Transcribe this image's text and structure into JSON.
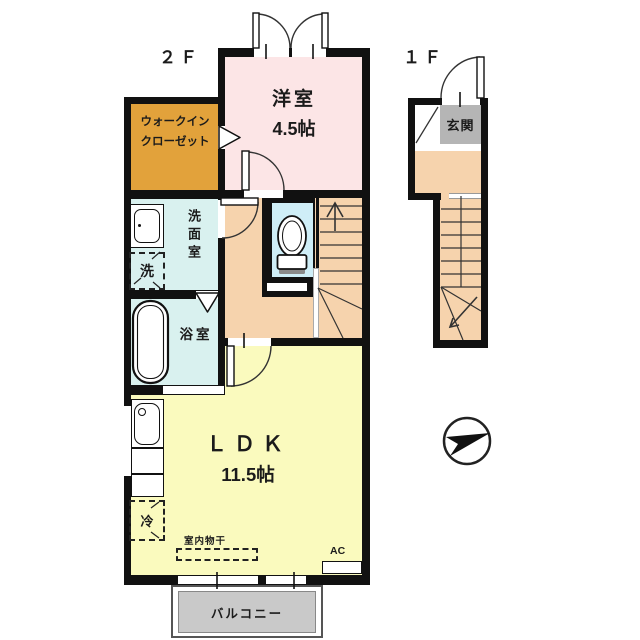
{
  "floor_labels": {
    "second_floor": "２Ｆ",
    "first_floor": "１Ｆ"
  },
  "rooms": {
    "western_room": {
      "name": "洋室",
      "area": "4.5帖"
    },
    "walk_in_closet": {
      "line1": "ウォークイン",
      "line2": "クローゼット"
    },
    "washroom": {
      "name": "洗面室"
    },
    "bathroom": {
      "name": "浴室"
    },
    "ldk": {
      "name": "ＬＤＫ",
      "area": "11.5帖"
    },
    "entrance": {
      "name": "玄関"
    },
    "balcony": {
      "name": "バルコニー"
    }
  },
  "fixtures": {
    "washing_machine": "洗",
    "refrigerator": "冷",
    "indoor_laundry": "室内物干",
    "air_conditioner": "AC"
  },
  "icons": {
    "compass": "north-direction-arrow",
    "stairs_up_arrow": "stair-direction-arrow",
    "toilet": "toilet-bowl",
    "bathtub": "bathtub"
  },
  "colors": {
    "wall": "#111111",
    "western_room": "#fce5e6",
    "walk_in_closet": "#e2a23b",
    "wet_rooms": "#d9f1ef",
    "toilet": "#cfeef7",
    "hall_stairs": "#f6d3ad",
    "ldk": "#fafabe",
    "balcony": "#c9c9c9",
    "entrance": "#b5b5b5"
  }
}
